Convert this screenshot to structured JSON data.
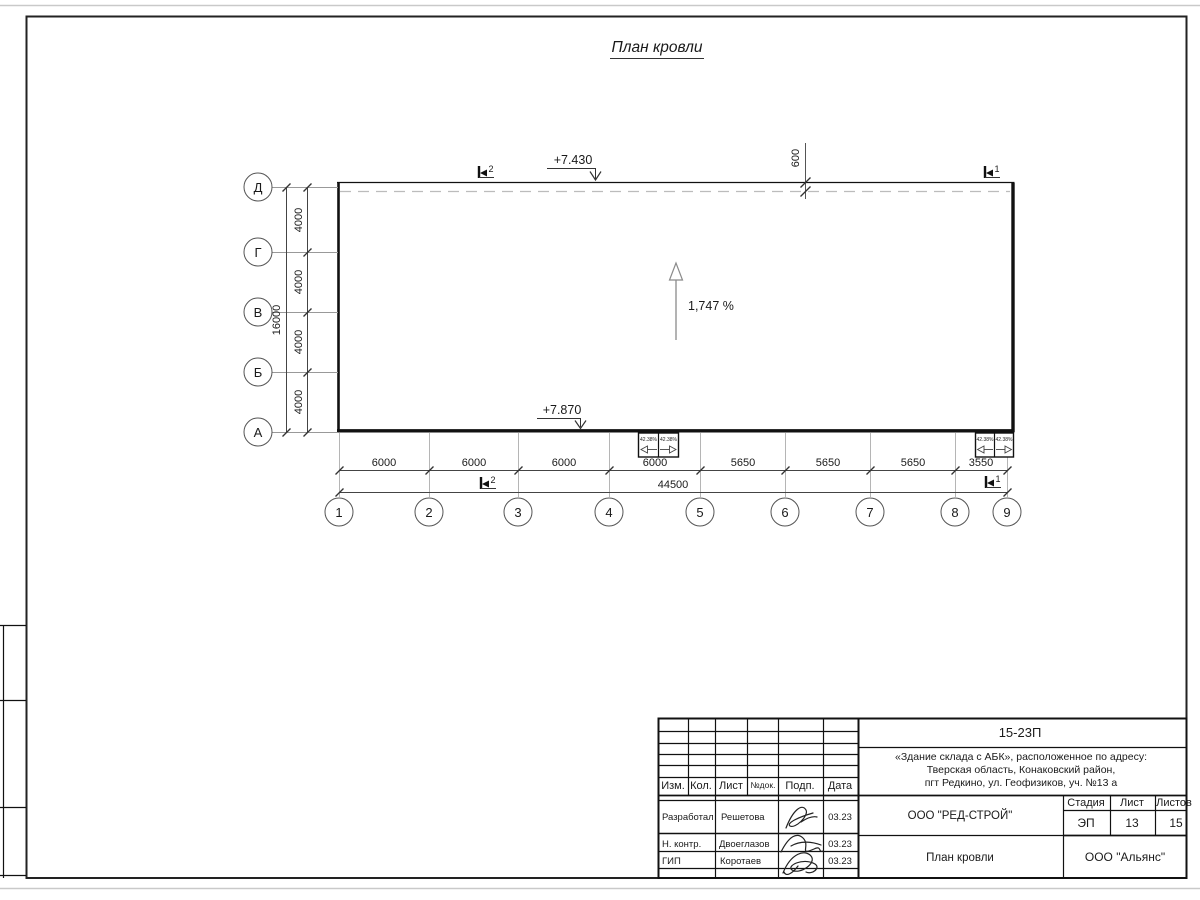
{
  "sheet_title": "План кровли",
  "plan": {
    "slope_label": "1,747 %",
    "elev_top": "+7.430",
    "elev_bottom": "+7.870",
    "parapet_dim": "600",
    "funnel_slope": "42.38%",
    "section_marks": {
      "s2": "2",
      "s1": "1"
    },
    "row_axes": [
      "Д",
      "Г",
      "В",
      "Б",
      "А"
    ],
    "row_dims": [
      "4000",
      "4000",
      "4000",
      "4000"
    ],
    "row_total": "16000",
    "col_axes": [
      "1",
      "2",
      "3",
      "4",
      "5",
      "6",
      "7",
      "8",
      "9"
    ],
    "col_dims": [
      "6000",
      "6000",
      "6000",
      "6000",
      "5650",
      "5650",
      "5650",
      "3550"
    ],
    "col_total": "44500"
  },
  "titleblock": {
    "doc_number": "15-23П",
    "project_line1": "«Здание склада с АБК», расположенное по адресу:",
    "project_line2": "Тверская область, Конаковский район,",
    "project_line3": "пгт Редкино, ул. Геофизиков, уч. №13 а",
    "org": "ООО \"РЕД-СТРОЙ\"",
    "drawing_name": "План кровли",
    "contractor": "ООО \"Альянс\"",
    "stage_label": "Стадия",
    "sheet_label": "Лист",
    "sheets_label": "Листов",
    "stage": "ЭП",
    "sheet_no": "13",
    "sheets_total": "15",
    "header": [
      "Изм.",
      "Кол.",
      "Лист",
      "№док.",
      "Подп.",
      "Дата"
    ],
    "rows": [
      {
        "role": "Разработал",
        "name": "Решетова",
        "date": "03.23"
      },
      {
        "role": "Н. контр.",
        "name": "Двоеглазов",
        "date": "03.23"
      },
      {
        "role": "ГИП",
        "name": "Коротаев",
        "date": "03.23"
      }
    ]
  }
}
